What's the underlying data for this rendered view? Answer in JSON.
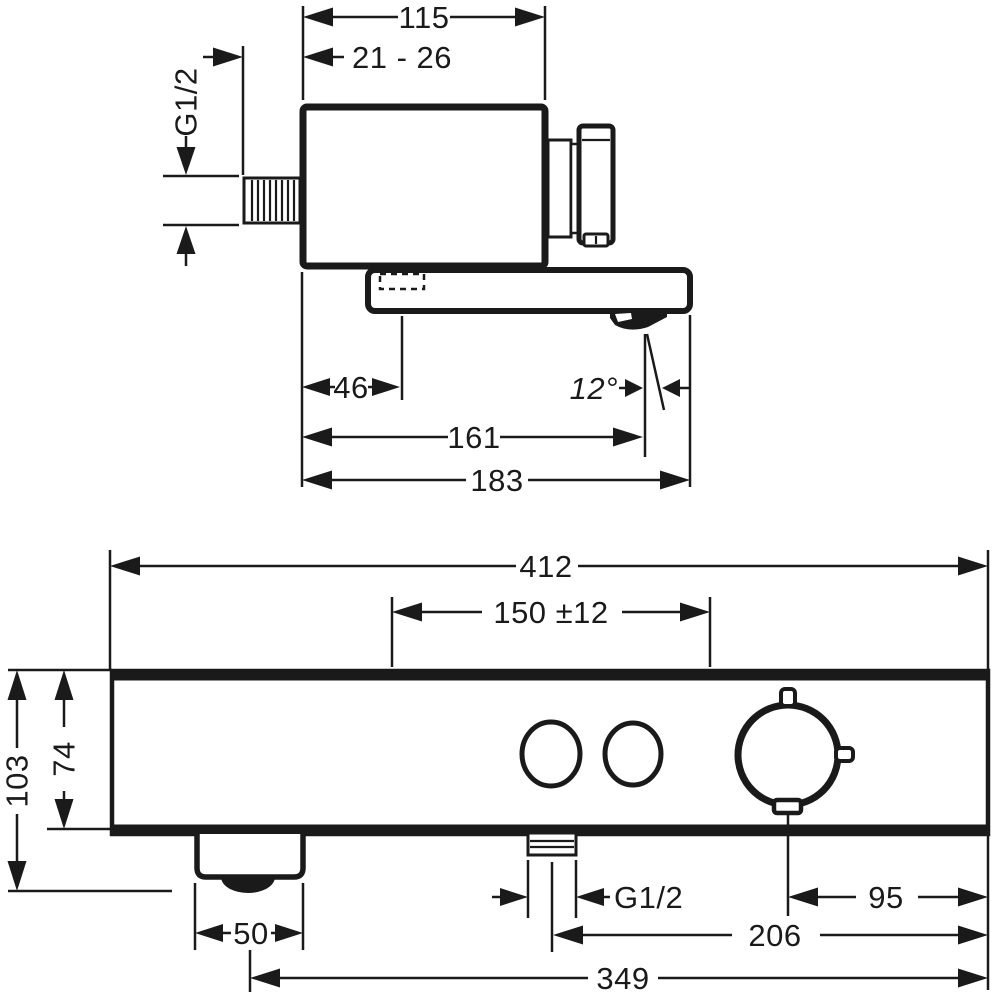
{
  "drawing": {
    "type": "technical-dimension-drawing",
    "product": "bath-mixer-side-and-front-view",
    "colors": {
      "line": "#1a1a1a",
      "background": "#ffffff"
    },
    "labels": {
      "side": {
        "width": "115",
        "wall": "21 - 26",
        "thread": "G1/2",
        "offset46": "46",
        "angle": "12°",
        "reach161": "161",
        "reach183": "183"
      },
      "front": {
        "width412": "412",
        "center150": "150 ±12",
        "height103": "103",
        "height74": "74",
        "thread": "G1/2",
        "dim95": "95",
        "dim50": "50",
        "dim206": "206",
        "dim349": "349"
      }
    }
  }
}
